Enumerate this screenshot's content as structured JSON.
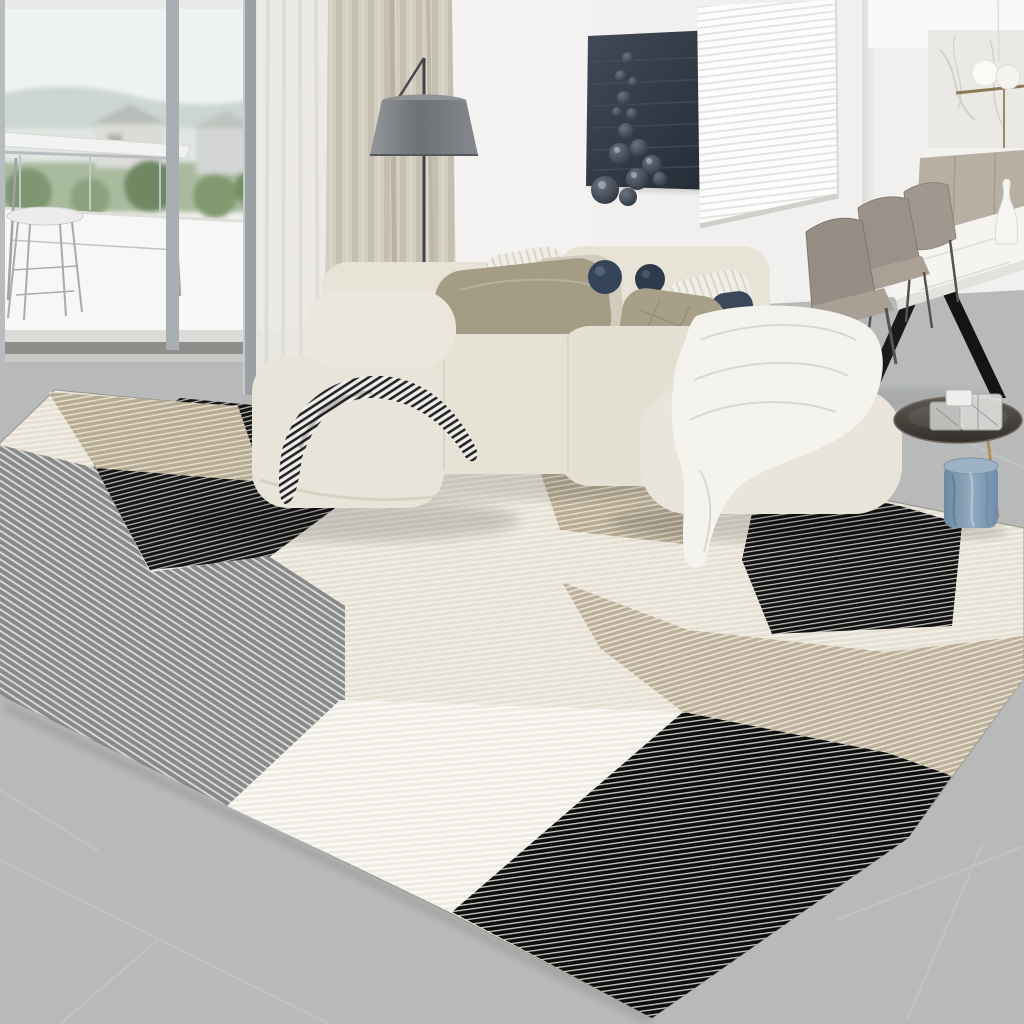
{
  "scene": {
    "type": "natural-image",
    "description": "Modern living room product photo: cream L-shaped sectional sofa with pillows and throws, geometric patchwork striped area rug in black, gray, tan and cream, gray tile floor, balcony window with outdoor view, beige curtain, gray floor lamp, dark wall art with spheres, white venetian blinds, kitchen with marble backsplash, white marble dining table with taupe leather chairs, round smoked-glass side table with blue vase"
  },
  "palette": {
    "wall": "#f1f0ee",
    "wall_corner_shade": "#e2e0de",
    "floor": "#b7bab9",
    "grout": "#c9cccb",
    "sofa_body": "#e8e3d7",
    "sofa_front": "#ddd7ca",
    "curtain_beige": "#d3cec1",
    "curtain_sheer": "#ebe9e4",
    "lamp_shade": "#797d81",
    "lamp_stem": "#3f4144",
    "art_panel": "#39414d",
    "art_sphere": "#3a424e",
    "blinds_white": "#fdfdfc",
    "marble_backsplash": "#eae9e5",
    "cabinet_taupe": "#b7afa2",
    "dining_table": "#f5f4f1",
    "table_leg_black": "#1a1a1c",
    "chair_taupe": "#968d84",
    "chair_leg": "#57524d",
    "vase_white": "#f6f5f2",
    "pendant_globe": "#fbfaf6",
    "pendant_bar_gold": "#8a7a55",
    "side_table_glass": "#4a4540",
    "side_table_leg_gold": "#b28e58",
    "vase_blue": "#7f97ad",
    "pillow_khaki": "#a49c85",
    "pillow_light": "#d2ccbe",
    "pillow_navy": "#36445a",
    "pillow_navy_dark": "#2e3a4c",
    "pillow_white": "#f0eee7",
    "throw_white": "#f4f3ee",
    "view_sky": "#eef2f1",
    "view_hills": "#ccd6d0",
    "view_green": "#a9bb9e",
    "balcony_parapet": "#f7f7f5",
    "window_frame": "#9aa0a4",
    "threshold": "#8e8d89"
  },
  "rug": {
    "style": "patchwork of fine-striped rectangles seen in perspective",
    "patches": {
      "cream": {
        "base": "#e6e1d4",
        "stripe": "#f4f1ea"
      },
      "white": {
        "base": "#efece4",
        "stripe": "#fcfbf8"
      },
      "tan": {
        "base": "#b6aa93",
        "stripe": "#e3dccb"
      },
      "tan_band": {
        "base": "#bcb09b",
        "stripe": "#ebe4d4"
      },
      "gray": {
        "base": "#87898a",
        "stripe": "#d6d6d2"
      },
      "black_left": {
        "base": "#161616",
        "stripe": "#b9b9b3"
      },
      "black_right": {
        "base": "#121212",
        "stripe": "#c4c4be"
      },
      "black_bottom": {
        "base": "#0e0e0e",
        "stripe": "#ccccc6"
      }
    },
    "throw_stripe": {
      "base": "#efeeea",
      "stripe": "#262626"
    }
  },
  "objects": [
    "balcony-window",
    "outdoor-bar-table",
    "outdoor-stool",
    "beige-curtain",
    "sheer-curtain",
    "floor-lamp",
    "wall-art-spheres",
    "venetian-blinds",
    "kitchen-backsplash",
    "pendant-lamp",
    "dining-table",
    "dining-chairs",
    "white-vase",
    "sectional-sofa",
    "pillows",
    "striped-throw",
    "white-throw",
    "side-table",
    "crystal-decor",
    "blue-vase",
    "patchwork-rug",
    "tile-floor"
  ]
}
